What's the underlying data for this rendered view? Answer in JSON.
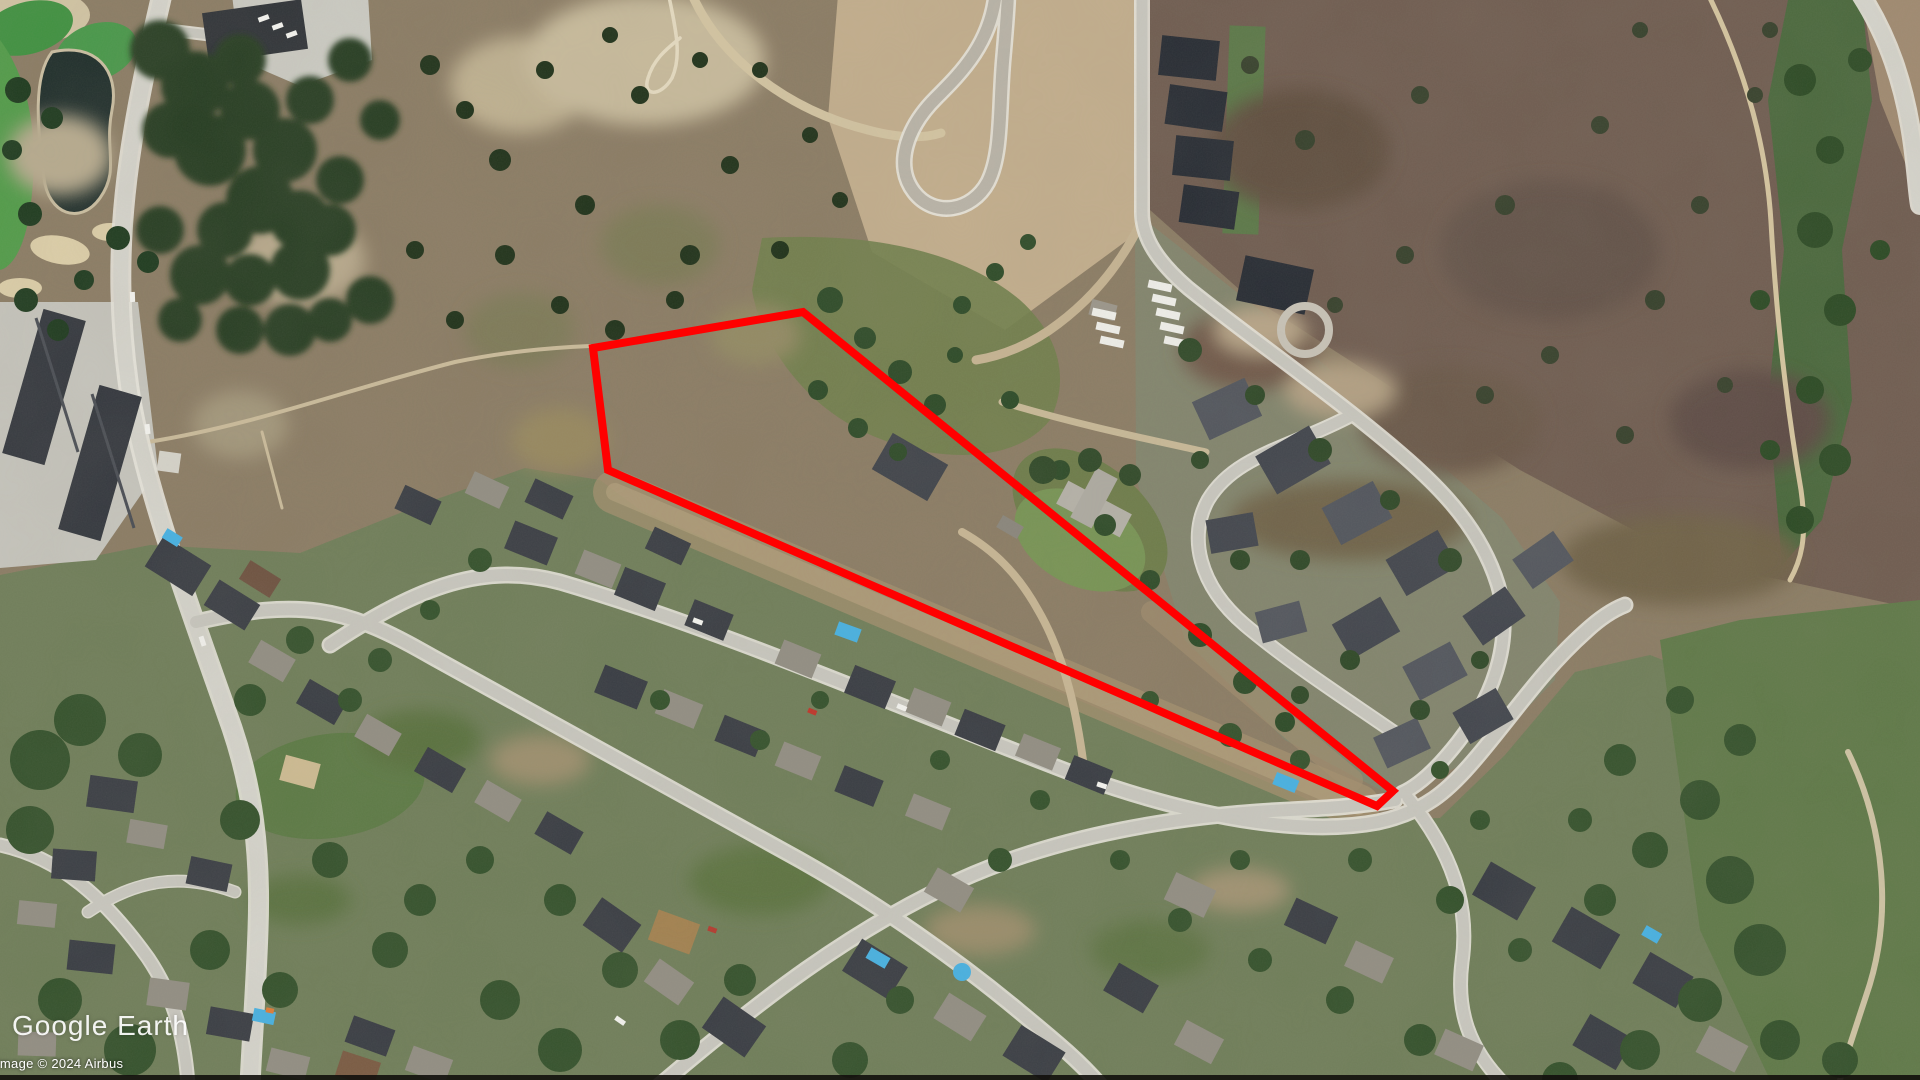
{
  "app": {
    "name": "Google Earth",
    "view": "satellite-aerial"
  },
  "watermark": {
    "brand": "Google Earth",
    "attribution": "Image © 2024 Airbus"
  },
  "overlay": {
    "parcel_outline": {
      "points": "593,348 803,312 1393,791 1377,806 608,470",
      "color": "#ff0000",
      "stroke_width": "8"
    }
  },
  "scene": {
    "description": "Hillside suburb with dry grassland hills, golf pond top-left, new cul-de-sac development top-center, creek corridor right, red boundary outline over vacant parcel",
    "colors": {
      "dry_hill": "#8b7c64",
      "ne_hill": "#6f5c50",
      "suburb_ground": "#6f7e59",
      "golf_green": "#3f9140",
      "pond": "#1f2e2b",
      "road": "#c9c8c0",
      "dirt_road": "#c9b896",
      "tree": "#2c4427",
      "roof_dark": "#383c43",
      "roof_light": "#928e83",
      "pool": "#46b2e4",
      "highlight": "#ff0000"
    }
  }
}
